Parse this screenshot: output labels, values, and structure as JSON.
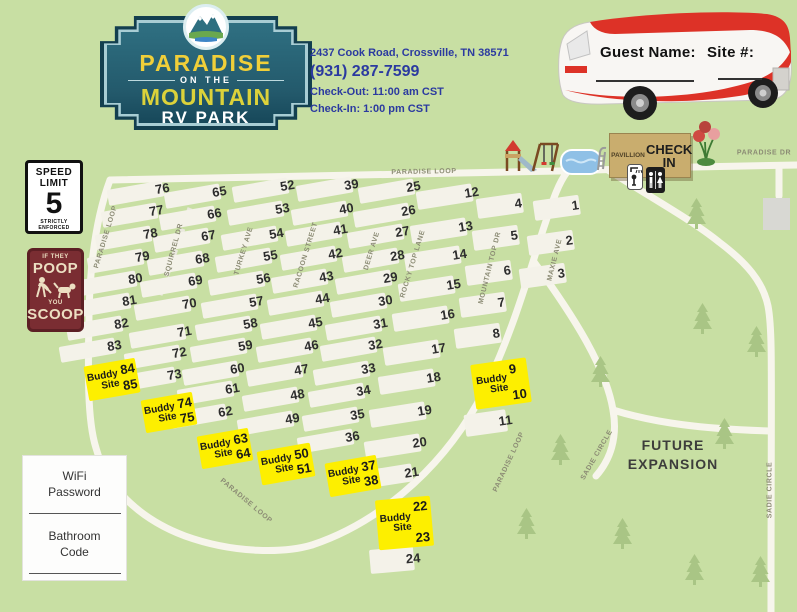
{
  "title": "Paradise on the Mountain RV Park Map",
  "header": {
    "logo": {
      "line1": "PARADISE",
      "line2": "ON THE",
      "line3": "MOUNTAIN",
      "line4": "RV PARK"
    },
    "info": {
      "address": "2437 Cook Road, Crossville, TN 38571",
      "phone": "(931) 287-7599",
      "checkout": "Check-Out: 11:00 am CST",
      "checkin": "Check-In: 1:00 pm CST"
    },
    "rv": {
      "guest_label": "Guest Name:",
      "site_label": "Site #:"
    }
  },
  "signs": {
    "speed": {
      "l1": "SPEED",
      "l2": "LIMIT",
      "big": "5",
      "l3": "STRICTLY",
      "l4": "ENFORCED"
    },
    "poop": {
      "s1": "IF THEY",
      "b1": "POOP",
      "s2": "YOU",
      "b2": "SCOOP"
    },
    "wifi_label": "WiFi Password",
    "bathroom_label": "Bathroom Code"
  },
  "amenities": {
    "pavillion_label": "PAVILLION",
    "checkin_label": "CHECK IN",
    "icons": {
      "playground": "playground-icon",
      "pool": "pool-icon",
      "shower": "shower-icon",
      "restroom": "restroom-icon",
      "flowers": "flowers-icon"
    }
  },
  "map": {
    "future_line1": "FUTURE",
    "future_line2": "EXPANSION",
    "buddy_label": [
      "Buddy",
      "Site"
    ],
    "road_labels": [
      {
        "t": "PARADISE LOOP",
        "x": 424,
        "y": 172,
        "r": -1
      },
      {
        "t": "PARADISE LOOP",
        "x": 106,
        "y": 237,
        "r": -73
      },
      {
        "t": "SQUIRREL DR",
        "x": 174,
        "y": 250,
        "r": -75
      },
      {
        "t": "TURKEY AVE",
        "x": 244,
        "y": 251,
        "r": -73
      },
      {
        "t": "RACOON STREET",
        "x": 306,
        "y": 255,
        "r": -73
      },
      {
        "t": "DEER AVE",
        "x": 372,
        "y": 251,
        "r": -73
      },
      {
        "t": "ROCKY TOP LANE",
        "x": 413,
        "y": 264,
        "r": -73
      },
      {
        "t": "MOUNTAIN TOP DR",
        "x": 490,
        "y": 268,
        "r": -76
      },
      {
        "t": "MAXIE AVE",
        "x": 555,
        "y": 260,
        "r": -76
      },
      {
        "t": "PARADISE LOOP",
        "x": 246,
        "y": 501,
        "r": 40
      },
      {
        "t": "PARADISE LOOP",
        "x": 509,
        "y": 462,
        "r": -65
      },
      {
        "t": "PARADISE DR",
        "x": 764,
        "y": 153,
        "r": 0
      },
      {
        "t": "SADIE CIRCLE",
        "x": 597,
        "y": 455,
        "r": -60
      },
      {
        "t": "SADIE CIRCLE",
        "x": 770,
        "y": 490,
        "r": -90
      }
    ],
    "sites": [
      {
        "n": 1,
        "x": 534,
        "y": 201,
        "r": -8,
        "w": 64,
        "h": 20
      },
      {
        "n": 2,
        "x": 528,
        "y": 236,
        "r": -8,
        "w": 64,
        "h": 20
      },
      {
        "n": 3,
        "x": 520,
        "y": 269,
        "r": -8,
        "w": 64,
        "h": 20
      },
      {
        "n": 4,
        "x": 477,
        "y": 199,
        "r": -8,
        "w": 64,
        "h": 20
      },
      {
        "n": 5,
        "x": 473,
        "y": 231,
        "r": -8,
        "w": 64,
        "h": 20
      },
      {
        "n": 6,
        "x": 466,
        "y": 266,
        "r": -8,
        "w": 64,
        "h": 20
      },
      {
        "n": 7,
        "x": 460,
        "y": 298,
        "r": -8,
        "w": 64,
        "h": 20
      },
      {
        "n": 8,
        "x": 455,
        "y": 329,
        "r": -8,
        "w": 64,
        "h": 20
      },
      {
        "n": 11,
        "x": 465,
        "y": 415,
        "r": -8,
        "w": 60,
        "h": 22
      },
      {
        "n": 12,
        "x": 417,
        "y": 192,
        "r": -9,
        "w": 74,
        "h": 18
      },
      {
        "n": 13,
        "x": 411,
        "y": 226,
        "r": -9,
        "w": 74,
        "h": 18
      },
      {
        "n": 14,
        "x": 405,
        "y": 254,
        "r": -9,
        "w": 74,
        "h": 18
      },
      {
        "n": 15,
        "x": 399,
        "y": 284,
        "r": -9,
        "w": 74,
        "h": 18
      },
      {
        "n": 16,
        "x": 393,
        "y": 314,
        "r": -9,
        "w": 74,
        "h": 18
      },
      {
        "n": 17,
        "x": 384,
        "y": 348,
        "r": -9,
        "w": 74,
        "h": 18
      },
      {
        "n": 18,
        "x": 379,
        "y": 377,
        "r": -9,
        "w": 74,
        "h": 18
      },
      {
        "n": 19,
        "x": 370,
        "y": 410,
        "r": -9,
        "w": 74,
        "h": 18
      },
      {
        "n": 20,
        "x": 365,
        "y": 442,
        "r": -9,
        "w": 74,
        "h": 18
      },
      {
        "n": 21,
        "x": 357,
        "y": 472,
        "r": -9,
        "w": 74,
        "h": 18
      },
      {
        "n": 24,
        "x": 370,
        "y": 550,
        "r": -5,
        "w": 62,
        "h": 24
      },
      {
        "n": 25,
        "x": 359,
        "y": 188
      },
      {
        "n": 26,
        "x": 354,
        "y": 212
      },
      {
        "n": 27,
        "x": 348,
        "y": 233
      },
      {
        "n": 28,
        "x": 343,
        "y": 257
      },
      {
        "n": 29,
        "x": 336,
        "y": 279
      },
      {
        "n": 30,
        "x": 331,
        "y": 302
      },
      {
        "n": 31,
        "x": 326,
        "y": 325
      },
      {
        "n": 32,
        "x": 321,
        "y": 346
      },
      {
        "n": 33,
        "x": 314,
        "y": 370
      },
      {
        "n": 34,
        "x": 309,
        "y": 392
      },
      {
        "n": 35,
        "x": 303,
        "y": 416
      },
      {
        "n": 36,
        "x": 298,
        "y": 438
      },
      {
        "n": 39,
        "x": 297,
        "y": 186
      },
      {
        "n": 40,
        "x": 292,
        "y": 210
      },
      {
        "n": 41,
        "x": 286,
        "y": 231
      },
      {
        "n": 42,
        "x": 281,
        "y": 255
      },
      {
        "n": 43,
        "x": 272,
        "y": 278
      },
      {
        "n": 44,
        "x": 268,
        "y": 300
      },
      {
        "n": 45,
        "x": 261,
        "y": 324
      },
      {
        "n": 46,
        "x": 257,
        "y": 347
      },
      {
        "n": 47,
        "x": 247,
        "y": 371
      },
      {
        "n": 48,
        "x": 243,
        "y": 396
      },
      {
        "n": 49,
        "x": 238,
        "y": 420
      },
      {
        "n": 52,
        "x": 233,
        "y": 187
      },
      {
        "n": 53,
        "x": 228,
        "y": 210
      },
      {
        "n": 54,
        "x": 222,
        "y": 235
      },
      {
        "n": 55,
        "x": 216,
        "y": 257
      },
      {
        "n": 56,
        "x": 209,
        "y": 280
      },
      {
        "n": 57,
        "x": 202,
        "y": 303
      },
      {
        "n": 58,
        "x": 196,
        "y": 325
      },
      {
        "n": 59,
        "x": 191,
        "y": 347
      },
      {
        "n": 60,
        "x": 183,
        "y": 370
      },
      {
        "n": 61,
        "x": 178,
        "y": 390
      },
      {
        "n": 62,
        "x": 171,
        "y": 413
      },
      {
        "n": 65,
        "x": 165,
        "y": 193
      },
      {
        "n": 66,
        "x": 160,
        "y": 215
      },
      {
        "n": 67,
        "x": 154,
        "y": 237
      },
      {
        "n": 68,
        "x": 148,
        "y": 260
      },
      {
        "n": 69,
        "x": 141,
        "y": 282
      },
      {
        "n": 70,
        "x": 135,
        "y": 305
      },
      {
        "n": 71,
        "x": 130,
        "y": 333
      },
      {
        "n": 72,
        "x": 125,
        "y": 354
      },
      {
        "n": 73,
        "x": 120,
        "y": 376
      },
      {
        "n": 76,
        "x": 108,
        "y": 190
      },
      {
        "n": 77,
        "x": 102,
        "y": 212
      },
      {
        "n": 78,
        "x": 96,
        "y": 235
      },
      {
        "n": 79,
        "x": 88,
        "y": 258
      },
      {
        "n": 80,
        "x": 81,
        "y": 280
      },
      {
        "n": 81,
        "x": 75,
        "y": 302
      },
      {
        "n": 82,
        "x": 67,
        "y": 325
      },
      {
        "n": 83,
        "x": 60,
        "y": 347
      }
    ],
    "buddy_sites": [
      {
        "a": 9,
        "b": 10,
        "x": 473,
        "y": 361,
        "r": -8,
        "w": 56,
        "h": 45
      },
      {
        "a": 22,
        "b": 23,
        "x": 377,
        "y": 498,
        "r": -5,
        "w": 55,
        "h": 50
      },
      {
        "a": 37,
        "b": 38,
        "x": 327,
        "y": 459,
        "r": -10,
        "w": 52,
        "h": 34
      },
      {
        "a": 50,
        "b": 51,
        "x": 259,
        "y": 447,
        "r": -10,
        "w": 54,
        "h": 34
      },
      {
        "a": 63,
        "b": 64,
        "x": 199,
        "y": 432,
        "r": -10,
        "w": 52,
        "h": 33
      },
      {
        "a": 74,
        "b": 75,
        "x": 143,
        "y": 396,
        "r": -10,
        "w": 52,
        "h": 33
      },
      {
        "a": 84,
        "b": 85,
        "x": 86,
        "y": 362,
        "r": -10,
        "w": 52,
        "h": 35
      }
    ],
    "trees": [
      [
        688,
        198
      ],
      [
        694,
        303
      ],
      [
        748,
        326
      ],
      [
        592,
        356
      ],
      [
        552,
        434
      ],
      [
        716,
        418
      ],
      [
        614,
        518
      ],
      [
        686,
        554
      ],
      [
        752,
        556
      ],
      [
        518,
        508
      ]
    ]
  },
  "colors": {
    "background": "#c8dfa3",
    "road": "#f7f5ec",
    "site_pad": "#f4f2e9",
    "buddy_yellow": "#fdef00",
    "logo_teal": "#1a4b5d",
    "logo_yellow": "#f0cf39",
    "info_blue": "#2b3aa0",
    "poop_maroon": "#7a2d32",
    "building_tan": "#c9ad6e",
    "rv_red": "#dd3227"
  }
}
